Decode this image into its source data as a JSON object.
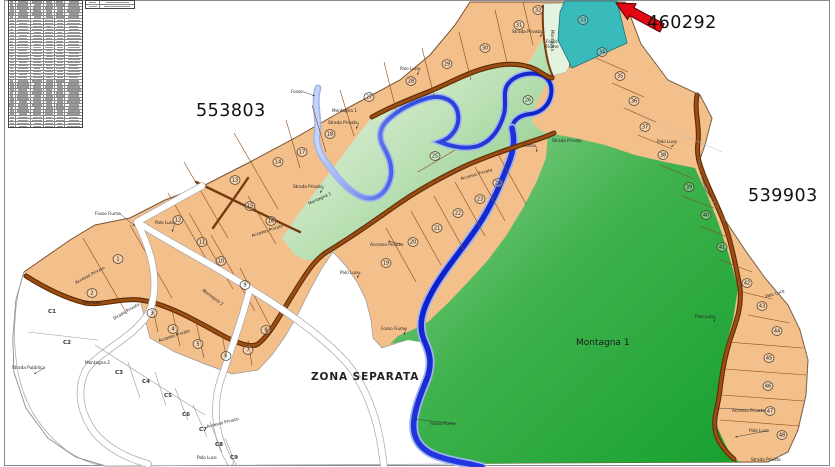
{
  "titles": {
    "zone_left": "553803",
    "zone_right": "539903",
    "zone_arrow": "460292",
    "zona_separata": "ZONA SEPARATA",
    "montagna_1_large": "Montagna 1"
  },
  "table": {
    "rows": 42,
    "columns": 6,
    "content_legible": false,
    "mini_rows": 2,
    "mini_columns": 2
  },
  "map": {
    "colors": {
      "parcel_fill": "#F3BF8B",
      "parcel_border": "#8B4A1A",
      "road_brown": "#9C4E12",
      "road_brown_dark": "#5E2B06",
      "river_blue": "#1B2FD0",
      "river_light": "#9FB4EE",
      "green_dark": "#17A02F",
      "green_light": "#96D496",
      "teal_parcel": "#3ABBBB",
      "highlight_red": "#E30613",
      "white_road": "#FFFFFF"
    },
    "parcels": [
      {
        "n": "1",
        "x": 118,
        "y": 259
      },
      {
        "n": "2",
        "x": 92,
        "y": 293
      },
      {
        "n": "3",
        "x": 152,
        "y": 313
      },
      {
        "n": "4",
        "x": 173,
        "y": 329
      },
      {
        "n": "5",
        "x": 198,
        "y": 344
      },
      {
        "n": "6",
        "x": 226,
        "y": 356
      },
      {
        "n": "7",
        "x": 248,
        "y": 350
      },
      {
        "n": "8",
        "x": 266,
        "y": 330
      },
      {
        "n": "9",
        "x": 245,
        "y": 285
      },
      {
        "n": "10",
        "x": 221,
        "y": 261
      },
      {
        "n": "11",
        "x": 202,
        "y": 242
      },
      {
        "n": "12",
        "x": 178,
        "y": 220
      },
      {
        "n": "13",
        "x": 235,
        "y": 180
      },
      {
        "n": "14",
        "x": 278,
        "y": 162
      },
      {
        "n": "15",
        "x": 250,
        "y": 206
      },
      {
        "n": "16",
        "x": 271,
        "y": 221
      },
      {
        "n": "17",
        "x": 302,
        "y": 152
      },
      {
        "n": "18",
        "x": 330,
        "y": 134
      },
      {
        "n": "19",
        "x": 386,
        "y": 263
      },
      {
        "n": "20",
        "x": 413,
        "y": 242
      },
      {
        "n": "21",
        "x": 437,
        "y": 228
      },
      {
        "n": "22",
        "x": 458,
        "y": 213
      },
      {
        "n": "23",
        "x": 480,
        "y": 199
      },
      {
        "n": "24",
        "x": 498,
        "y": 183
      },
      {
        "n": "25",
        "x": 435,
        "y": 156
      },
      {
        "n": "26",
        "x": 528,
        "y": 100
      },
      {
        "n": "27",
        "x": 369,
        "y": 97
      },
      {
        "n": "28",
        "x": 411,
        "y": 81
      },
      {
        "n": "29",
        "x": 447,
        "y": 64
      },
      {
        "n": "30",
        "x": 485,
        "y": 48
      },
      {
        "n": "31",
        "x": 519,
        "y": 25
      },
      {
        "n": "32",
        "x": 538,
        "y": 10
      },
      {
        "n": "33",
        "x": 583,
        "y": 20
      },
      {
        "n": "34",
        "x": 602,
        "y": 52
      },
      {
        "n": "35",
        "x": 620,
        "y": 76
      },
      {
        "n": "36",
        "x": 634,
        "y": 101
      },
      {
        "n": "37",
        "x": 645,
        "y": 127
      },
      {
        "n": "38",
        "x": 663,
        "y": 155
      },
      {
        "n": "39",
        "x": 689,
        "y": 187
      },
      {
        "n": "40",
        "x": 706,
        "y": 215
      },
      {
        "n": "41",
        "x": 722,
        "y": 247
      },
      {
        "n": "42",
        "x": 747,
        "y": 283
      },
      {
        "n": "43",
        "x": 762,
        "y": 306
      },
      {
        "n": "44",
        "x": 777,
        "y": 331
      },
      {
        "n": "45",
        "x": 769,
        "y": 358
      },
      {
        "n": "46",
        "x": 768,
        "y": 386
      },
      {
        "n": "47",
        "x": 770,
        "y": 411
      },
      {
        "n": "48",
        "x": 782,
        "y": 435
      }
    ],
    "c_parcels": [
      {
        "n": "C1",
        "x": 52,
        "y": 313
      },
      {
        "n": "C2",
        "x": 67,
        "y": 344
      },
      {
        "n": "C3",
        "x": 119,
        "y": 374
      },
      {
        "n": "C4",
        "x": 146,
        "y": 383
      },
      {
        "n": "C5",
        "x": 168,
        "y": 397
      },
      {
        "n": "C6",
        "x": 186,
        "y": 416
      },
      {
        "n": "C7",
        "x": 203,
        "y": 431
      },
      {
        "n": "C8",
        "x": 219,
        "y": 446
      },
      {
        "n": "C9",
        "x": 234,
        "y": 459
      }
    ],
    "labels": [
      {
        "t": "Fosso",
        "x": 291,
        "y": 93,
        "r": 0,
        "lx": 315,
        "ly": 96
      },
      {
        "t": "Montagna 1",
        "x": 332,
        "y": 112,
        "r": 0
      },
      {
        "t": "Strada Privata",
        "x": 328,
        "y": 124,
        "r": 0,
        "lx": 356,
        "ly": 129
      },
      {
        "t": "Strada Privata",
        "x": 293,
        "y": 188,
        "r": 0,
        "lx": 320,
        "ly": 193
      },
      {
        "t": "Montagna 1",
        "x": 309,
        "y": 205,
        "r": -25
      },
      {
        "t": "Fosso Fiume",
        "x": 95,
        "y": 215,
        "r": 0,
        "lx": 135,
        "ly": 226
      },
      {
        "t": "Palo Luce",
        "x": 155,
        "y": 224,
        "r": 0,
        "lx": 172,
        "ly": 232
      },
      {
        "t": "Accesso Privato",
        "x": 252,
        "y": 237,
        "r": -18
      },
      {
        "t": "Strada Privata",
        "x": 512,
        "y": 33,
        "r": 0,
        "lx": 540,
        "ly": 37
      },
      {
        "t": "Montagna",
        "x": 551,
        "y": 30,
        "r": 90
      },
      {
        "t": "Fosso",
        "x": 546,
        "y": 43,
        "r": 0
      },
      {
        "t": "Fiume",
        "x": 546,
        "y": 48,
        "r": 0
      },
      {
        "t": "Palo Luce",
        "x": 400,
        "y": 70,
        "r": 0,
        "lx": 417,
        "ly": 75
      },
      {
        "t": "Accesso Privato",
        "x": 461,
        "y": 180,
        "r": -16
      },
      {
        "t": "Accesso Privato",
        "x": 370,
        "y": 246,
        "r": 0,
        "lx": 388,
        "ly": 241
      },
      {
        "t": "Palo Luce",
        "x": 340,
        "y": 274,
        "r": 0,
        "lx": 357,
        "ly": 278
      },
      {
        "t": "Fosso",
        "x": 524,
        "y": 147,
        "r": 0,
        "lx": 537,
        "ly": 152
      },
      {
        "t": "Strada Privata",
        "x": 552,
        "y": 142,
        "r": 0
      },
      {
        "t": "Fosso Fiume",
        "x": 430,
        "y": 425,
        "r": 0,
        "lx": 414,
        "ly": 419
      },
      {
        "t": "Fosso Fiume",
        "x": 381,
        "y": 330,
        "r": 0,
        "lx": 404,
        "ly": 335
      },
      {
        "t": "Strada Pubblica",
        "x": 12,
        "y": 369,
        "r": 0,
        "lx": 34,
        "ly": 374
      },
      {
        "t": "Accesso Privato",
        "x": 76,
        "y": 284,
        "r": -28
      },
      {
        "t": "Palo Luce",
        "x": 82,
        "y": 304,
        "r": 0
      },
      {
        "t": "Strada Privata",
        "x": 114,
        "y": 320,
        "r": -30
      },
      {
        "t": "Accesso Privato",
        "x": 159,
        "y": 342,
        "r": -18
      },
      {
        "t": "Montagna 2",
        "x": 85,
        "y": 364,
        "r": 0
      },
      {
        "t": "Montagna 2",
        "x": 202,
        "y": 291,
        "r": 36
      },
      {
        "t": "Palo Luce",
        "x": 695,
        "y": 318,
        "r": 0,
        "lx": 714,
        "ly": 322
      },
      {
        "t": "Palo Luce",
        "x": 657,
        "y": 143,
        "r": 0,
        "lx": 671,
        "ly": 147
      },
      {
        "t": "Accesso Privato",
        "x": 732,
        "y": 412,
        "r": 0,
        "lx": 717,
        "ly": 408
      },
      {
        "t": "Palo Luce",
        "x": 749,
        "y": 432,
        "r": 0,
        "lx": 735,
        "ly": 437
      },
      {
        "t": "Palo Luce",
        "x": 766,
        "y": 298,
        "r": -18
      },
      {
        "t": "Accesso Privato",
        "x": 207,
        "y": 428,
        "r": -14
      },
      {
        "t": "Palo Luce",
        "x": 197,
        "y": 459,
        "r": 0
      },
      {
        "t": "Strada Privata",
        "x": 751,
        "y": 461,
        "r": 0
      }
    ]
  }
}
